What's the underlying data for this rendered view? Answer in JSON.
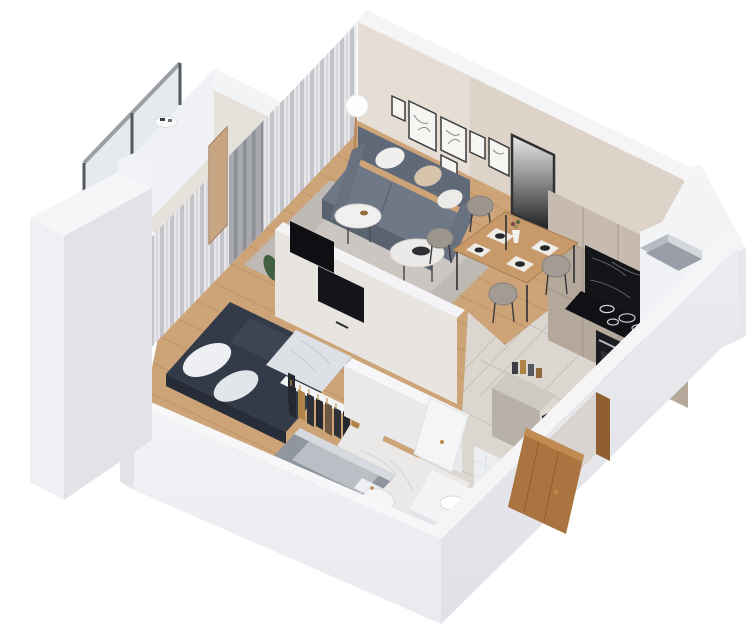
{
  "meta": {
    "description": "3D isometric cutaway (dollhouse) render of a one-bedroom studio apartment floor plan, viewed from above at an angle, on a plain white background. No text labels are visible.",
    "view": "axonometric top-down cutaway",
    "background": "#ffffff",
    "text_content": "none"
  },
  "palette": {
    "bg": "#ffffff",
    "wallTop": "#f5f5f7",
    "wallFaceLight": "#f0f1f4",
    "wallFaceMid": "#e7e8ec",
    "wallFaceDark": "#dcdde2",
    "innerBeige": "#ddd3c9",
    "innerBeigeLight": "#eae2d9",
    "woodFloor": "#cda378",
    "woodLine": "#b68a5e",
    "tileFloor": "#dbd6d0",
    "tileLine": "#c6c0b9",
    "marbleFloor": "#ebe9e8",
    "rug": "#beb9b4",
    "rugInner": "#cbc6c1",
    "sofa": "#6e7886",
    "sofaDark": "#59626f",
    "sofaBack": "#5f6977",
    "pillowWhite": "#f0efed",
    "pillowTan": "#d6c3aa",
    "bedDuvet": "#333b49",
    "bedThrow": "#dde1e5",
    "wardrobeClothes": "#25282e",
    "hangerWood": "#c89a58",
    "kitchenCabinet": "#b4a89b",
    "kitchenCabinetLight": "#c6bbae",
    "counterMarble": "#141519",
    "applianceBlack": "#1b1c20",
    "diningWood": "#c89a6a",
    "chairGray": "#9c968f",
    "doorWood": "#a9743f",
    "curtainSheer": "#e7e7e9",
    "curtainGray": "#a7a9af",
    "plantGreen": "#41603f",
    "tubApron": "#8f969d",
    "fixtureWhite": "#f4f5f7",
    "brass": "#b98b4a",
    "tvBlack": "#0e0f12",
    "glassRail": "#c9d6dd"
  },
  "scene": {
    "rooms": [
      {
        "name": "living-room",
        "furniture": [
          "gray two-seat sofa with white and tan pillows",
          "two round white coffee tables",
          "light gray area rug",
          "globe floor lamp",
          "gallery wall of six framed sketches",
          "potted plant"
        ]
      },
      {
        "name": "dining-area",
        "furniture": [
          "wooden dining table with four place settings and vase",
          "four gray upholstered chairs",
          "large dark abstract wall art"
        ]
      },
      {
        "name": "kitchen",
        "furniture": [
          "tall taupe cabinet wall",
          "black marble backsplash and countertop",
          "induction cooktop with four burners",
          "built-in black oven",
          "side counter with cutting board and bottles"
        ]
      },
      {
        "name": "bedroom",
        "furniture": [
          "double bed with dark navy duvet and white pillows",
          "open clothes rack with hanging garments",
          "window wall with gray and sheer curtains",
          "wall-mounted TVs on room divider"
        ]
      },
      {
        "name": "bathroom",
        "furniture": [
          "gray tiled bathtub",
          "white toilet with brass button",
          "white vanity with basin",
          "dark glass panel",
          "marble floor",
          "white door ajar with brass handle"
        ]
      },
      {
        "name": "hallway",
        "furniture": [
          "large-format tile floor",
          "shoe shelf unit with shoes and books",
          "open wooden entrance door"
        ]
      },
      {
        "name": "balcony",
        "furniture": [
          "glass railing with metal posts",
          "white parapet walls",
          "small white table"
        ]
      }
    ],
    "exterior": [
      "white cutaway exterior walls",
      "ventilation shaft opening near kitchen corner",
      "detached neighbor wall slab at far left"
    ]
  }
}
